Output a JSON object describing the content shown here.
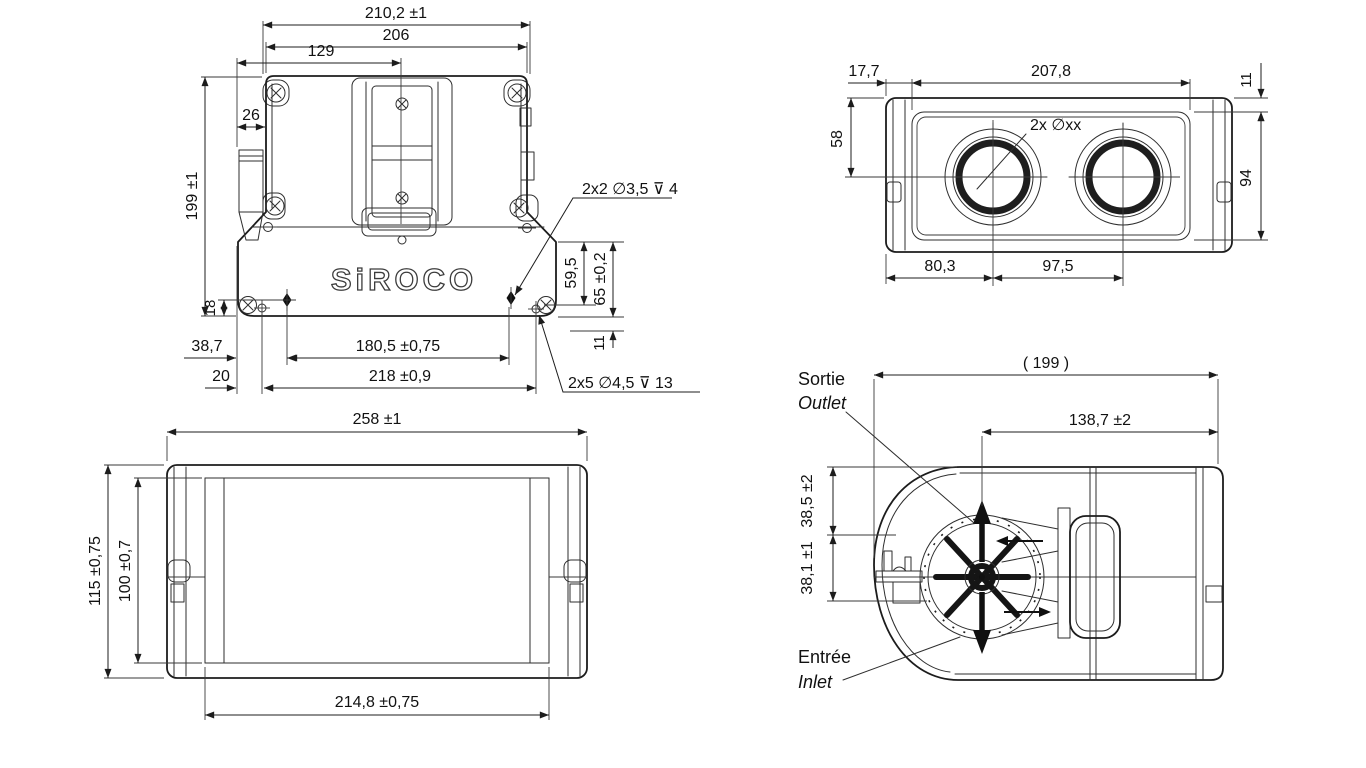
{
  "logo_text": "SiROCO",
  "front_view": {
    "dim_overall_width": "210,2 ±1",
    "dim_body_width": "206",
    "dim_center_offset": "129",
    "dim_connector": "26",
    "dim_overall_height": "199 ±1",
    "dim_foot": "18",
    "dim_left_offset": "38,7",
    "dim_edge_hole": "20",
    "dim_hole_span": "180,5 ±0,75",
    "dim_mount_span": "218 ±0,9",
    "dim_drop_1": "59,5",
    "dim_drop_2": "65 ±0,2",
    "dim_step": "11",
    "callout_holes_upper": "2x2 ∅3,5 ⊽ 4",
    "callout_holes_lower": "2x5 ∅4,5 ⊽ 13"
  },
  "top_view": {
    "dim_edge_inset": "17,7",
    "dim_panel_width": "207,8",
    "dim_top_inset": "11",
    "dim_port_drop": "58",
    "dim_panel_height": "94",
    "callout_ports": "2x ∅xx",
    "dim_port_offset": "80,3",
    "dim_port_spacing": "97,5"
  },
  "bottom_view": {
    "dim_overall_width": "258 ±1",
    "dim_overall_height": "115 ±0,75",
    "dim_inner_height": "100 ±0,7",
    "dim_inner_width": "214,8 ±0,75"
  },
  "side_view": {
    "dim_overall_depth": "( 199 )",
    "dim_motor_span": "138,7 ±2",
    "dim_outlet_drop": "38,5 ±2",
    "dim_axis_drop": "38,1 ±1",
    "label_outlet_fr": "Sortie",
    "label_outlet_en": "Outlet",
    "label_inlet_fr": "Entrée",
    "label_inlet_en": "Inlet"
  }
}
